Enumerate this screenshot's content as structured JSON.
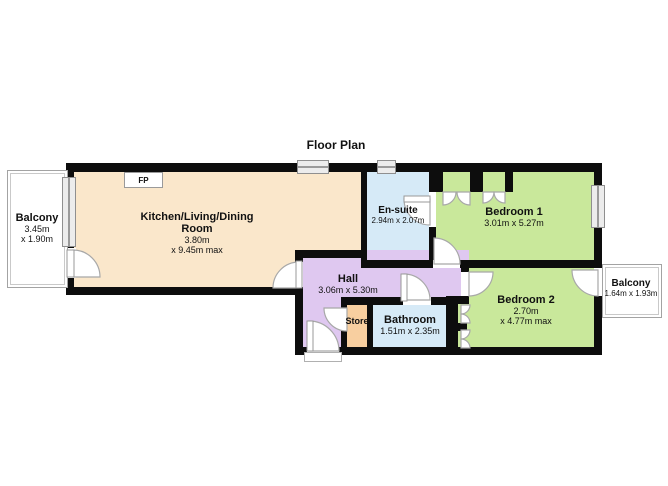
{
  "title": "Floor Plan",
  "colors": {
    "wall": "#0d0d0d",
    "kitchen_fill": "#fae7cb",
    "bedroom_fill": "#c9e89b",
    "bath_fill": "#d6eaf7",
    "hall_fill": "#dfc8f0",
    "store_fill": "#f8cfa0",
    "window_fill": "#ececec",
    "door_arc": "#a8a8a8"
  },
  "rooms": {
    "kitchen": {
      "line1": "Kitchen/Living/Dining",
      "line2": "Room",
      "dim1": "3.80m",
      "dim2": "x 9.45m max"
    },
    "ensuite": {
      "name": "En-suite",
      "dims": "2.94m x 2.07m"
    },
    "bedroom1": {
      "name": "Bedroom 1",
      "dims": "3.01m x 5.27m"
    },
    "bedroom2": {
      "name": "Bedroom 2",
      "dim1": "2.70m",
      "dim2": "x 4.77m max"
    },
    "hall": {
      "name": "Hall",
      "dims": "3.06m x 5.30m"
    },
    "bathroom": {
      "name": "Bathroom",
      "dims": "1.51m x 2.35m"
    },
    "store": {
      "name": "Store"
    },
    "balcony_left": {
      "name": "Balcony",
      "dim1": "3.45m",
      "dim2": "x 1.90m"
    },
    "balcony_right": {
      "name": "Balcony",
      "dims": "1.64m x 1.93m"
    },
    "fireplace": {
      "label": "FP"
    }
  }
}
